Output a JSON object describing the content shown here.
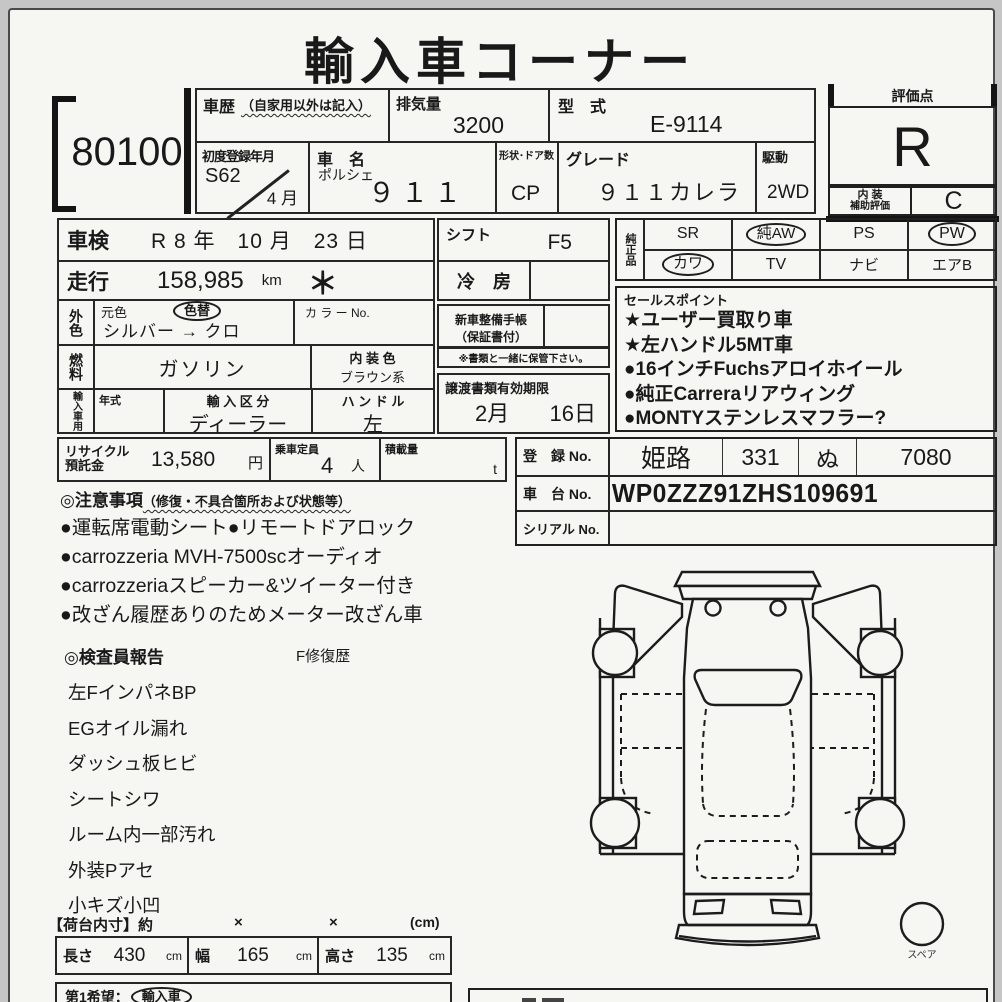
{
  "title": "輸入車コーナー",
  "lot_no": "80100",
  "header": {
    "shareki_label": "車歴",
    "shareki_note": "（自家用以外は記入）",
    "haikiryo_label": "排気量",
    "haikiryo_value": "3200",
    "katashiki_label": "型　式",
    "katashiki_value": "E-9114",
    "first_reg_label": "初度登録年月",
    "first_reg_year": "S62",
    "first_reg_month": "4 月",
    "car_name_label": "車　名",
    "car_maker": "ポルシェ",
    "car_model": "９１１",
    "shape_label": "形状･ドア数",
    "shape_value": "CP",
    "grade_label": "グレード",
    "grade_value": "９１１カレラ",
    "drive_label": "駆動",
    "drive_value": "2WD",
    "rating_label": "評価点",
    "rating_value": "R",
    "interior_label1": "内 装",
    "interior_label2": "補助評価",
    "interior_value": "C"
  },
  "left_table": {
    "shaken_label": "車検",
    "shaken_value": "R 8 年　10 月　23 日",
    "soko_label": "走行",
    "soko_value": "158,985",
    "soko_unit": "km",
    "soko_mark": "＊",
    "gaisyoku_label": "外色",
    "motoiro_label": "元色",
    "irokae_label": "色替",
    "color_value": "シルバー → クロ",
    "color_no_label": "カ ラ ー No.",
    "nenryo_label": "燃料",
    "nenryo_value": "ガソリン",
    "naisou_label": "内 装 色",
    "naisou_value": "ブラウン系",
    "import_label": "輸入車用",
    "nenshiki_label": "年式",
    "kubun_label": "輸 入 区 分",
    "kubun_value": "ディーラー",
    "handle_label": "ハ ン ド ル",
    "handle_value": "左"
  },
  "recycle": {
    "label1": "リサイクル",
    "label2": "預託金",
    "value": "13,580",
    "value_unit": "円",
    "teiin_label": "乗車定員",
    "teiin_value": "4",
    "teiin_unit": "人",
    "sekisai_label": "積載量",
    "sekisai_unit": "t"
  },
  "middle": {
    "shift_label": "シフト",
    "shift_value": "F5",
    "aircon_label": "冷　房",
    "aircon_value": "",
    "techou_label1": "新車整備手帳",
    "techou_label2": "（保証書付）",
    "techou_value": "",
    "note": "※書類と一緒に保管下さい。",
    "joto_label": "譲渡書類有効期限",
    "joto_month": "2月",
    "joto_day": "16日"
  },
  "equipment": {
    "label": "純正品",
    "row1": [
      {
        "text": "SR",
        "circled": false
      },
      {
        "text": "純AW",
        "circled": true
      },
      {
        "text": "PS",
        "circled": false
      },
      {
        "text": "PW",
        "circled": true
      }
    ],
    "row2": [
      {
        "text": "カワ",
        "circled": true
      },
      {
        "text": "TV",
        "circled": false
      },
      {
        "text": "ナビ",
        "circled": false
      },
      {
        "text": "エアB",
        "circled": false
      }
    ]
  },
  "sales_points": {
    "label": "セールスポイント",
    "items": [
      "★ユーザー買取り車",
      "★左ハンドル5MT車",
      "●16インチFuchsアロイホイール",
      "●純正Carreraリアウィング",
      "●MONTYステンレスマフラー?"
    ]
  },
  "registration": {
    "touroku_label": "登　録 No.",
    "touroku_area": "姫路",
    "touroku_class": "331",
    "touroku_kana": "ぬ",
    "touroku_number": "7080",
    "shadai_label": "車　台 No.",
    "shadai_value": "WP0ZZZ91ZHS109691",
    "serial_label": "シリアル No.",
    "serial_value": ""
  },
  "cautions": {
    "label": "◎注意事項",
    "label_note": "（修復・不具合箇所および状態等）",
    "items": [
      "●運転席電動シート●リモートドアロック",
      "●carrozzeria MVH-7500scオーディオ",
      "●carrozzeriaスピーカー&ツイーター付き",
      "●改ざん履歴ありのためメーター改ざん車"
    ]
  },
  "inspector": {
    "label": "◎検査員報告",
    "repair_label": "F修復歴",
    "items": [
      "左FインパネBP",
      "EGオイル漏れ",
      "ダッシュ板ヒビ",
      "シートシワ",
      "ルーム内一部汚れ",
      "外装Pアセ",
      "小キズ小凹"
    ]
  },
  "cargo": {
    "label": "【荷台内寸】約",
    "x1": "×",
    "x2": "×",
    "unit": "(cm)",
    "length_label": "長さ",
    "length_value": "430",
    "length_unit": "cm",
    "width_label": "幅",
    "width_value": "165",
    "width_unit": "cm",
    "height_label": "高さ",
    "height_value": "135",
    "height_unit": "cm"
  },
  "bottom": {
    "first_choice_label": "第1希望：",
    "first_choice_value": "輸入車"
  },
  "diagram": {
    "spare_label": "スペア"
  }
}
